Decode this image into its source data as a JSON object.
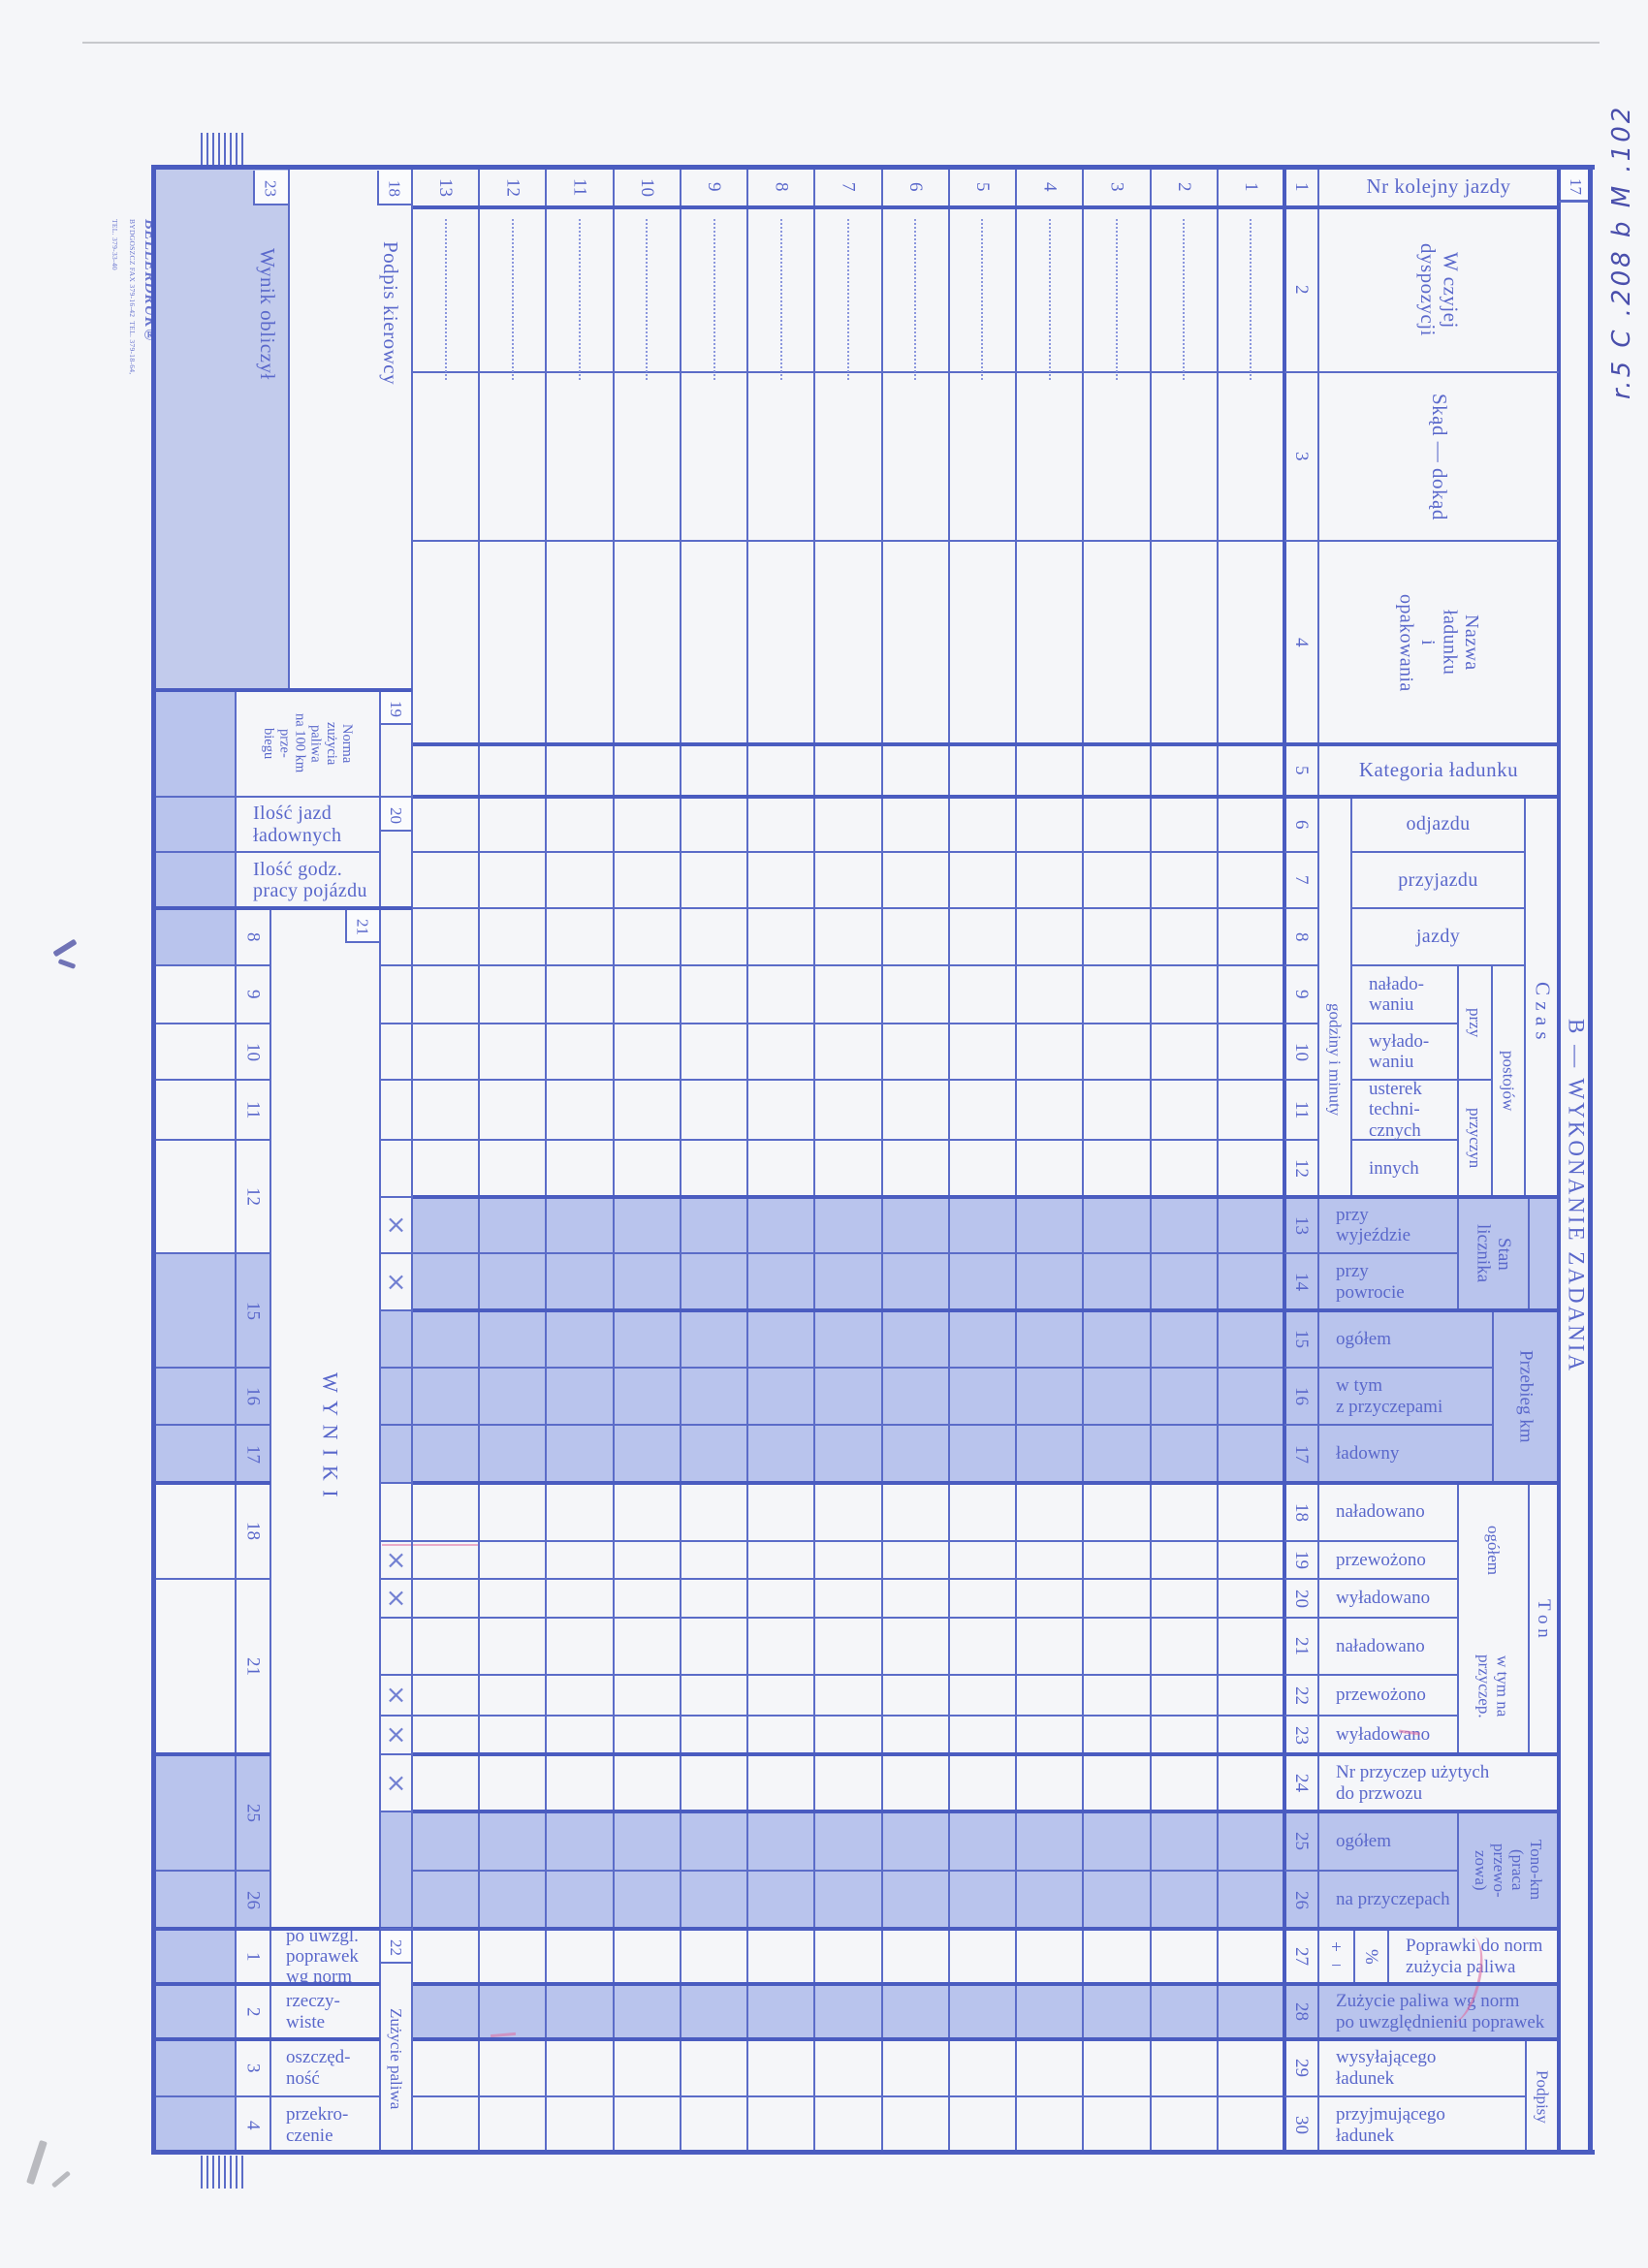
{
  "form": {
    "section_title": "B — WYKONANIE ZADANIA",
    "corner_number": "17",
    "trip_row_numbers": [
      "13",
      "12",
      "11",
      "10",
      "9",
      "8",
      "7",
      "6",
      "5",
      "4",
      "3",
      "2",
      "1"
    ],
    "columns": [
      {
        "num": "1",
        "label": "Nr kolejny jazdy"
      },
      {
        "num": "2",
        "label": "W czyjej\ndyspozycji"
      },
      {
        "num": "3",
        "label": "Skąd — dokąd"
      },
      {
        "num": "4",
        "label": "Nazwa\nładunku\ni\nopakowania"
      },
      {
        "num": "5",
        "label": "Kategoria ładunku"
      },
      {
        "num": "6",
        "label": "odjazdu"
      },
      {
        "num": "7",
        "label": "przyjazdu"
      },
      {
        "num": "8",
        "label": "jazdy"
      },
      {
        "num": "9",
        "label": "nałado-\nwaniu"
      },
      {
        "num": "10",
        "label": "wyłado-\nwaniu"
      },
      {
        "num": "11",
        "label": "usterek\ntechni-\ncznych"
      },
      {
        "num": "12",
        "label": "innych"
      },
      {
        "num": "13",
        "label": "przy\nwyjeździe"
      },
      {
        "num": "14",
        "label": "przy\npowrocie"
      },
      {
        "num": "15",
        "label": "ogółem"
      },
      {
        "num": "16",
        "label": "w tym\nz przyczepami"
      },
      {
        "num": "17",
        "label": "ładowny"
      },
      {
        "num": "18",
        "label": "naładowano"
      },
      {
        "num": "19",
        "label": "przewożono"
      },
      {
        "num": "20",
        "label": "wyładowano"
      },
      {
        "num": "21",
        "label": "naładowano"
      },
      {
        "num": "22",
        "label": "przewożono"
      },
      {
        "num": "23",
        "label": "wyładowano"
      },
      {
        "num": "24",
        "label": "Nr przyczep użytych\ndo przwozu"
      },
      {
        "num": "25",
        "label": "ogółem"
      },
      {
        "num": "26",
        "label": "na przyczepach"
      },
      {
        "num": "27",
        "label": "Poprawki do norm\nzużycia paliwa",
        "signs": "+\n−",
        "percent": "%"
      },
      {
        "num": "28",
        "label": "Zużycie paliwa wg norm\npo uwzględnieniu poprawek"
      },
      {
        "num": "29",
        "label": "wysyłającego\nładunek"
      },
      {
        "num": "30",
        "label": "przyjmującego\nładunek"
      }
    ],
    "groups": {
      "czas": "C z a s",
      "godziny": "godziny i minuty",
      "przy": "przy",
      "postojow": "postojów",
      "przyczyn": "przyczyn",
      "stan_licznika": "Stan\nlicznika",
      "przebieg": "Przebieg km",
      "ogolem": "ogółem",
      "w_tym_na_przyczep": "w tym na\nprzyczep.",
      "ton": "T o n",
      "tono_km": "Tono-km\n(praca\nprzewo-\nzowa)",
      "podpisy": "Podpisy"
    },
    "summary": {
      "wynik_obliczyl": {
        "num": "23",
        "label": "Wynik obliczył"
      },
      "podpis_kierowcy": {
        "num": "18",
        "label": "Podpis kierowcy"
      },
      "norma": {
        "num": "19",
        "label": "Norma\nzużycia\npaliwa\nna 100 km\nprze-\nbiegu"
      },
      "ilosc_jazd": {
        "num": "20",
        "label": "Ilość jazd\nładownych"
      },
      "ilosc_godz": {
        "label": "Ilość godz.\npracy pojázdu"
      },
      "wyniki_box_num": "21",
      "wyniki_title": "W Y N I K I",
      "wyniki_row_numbers": [
        "8",
        "9",
        "10",
        "11",
        "12",
        "15",
        "16",
        "17",
        "18",
        "21",
        "25",
        "26"
      ],
      "zuzycie": {
        "num": "22",
        "label": "Zużycie paliwa",
        "rows": [
          {
            "num": "1",
            "label": "po uwzgl.\npoprawek\nwg norm"
          },
          {
            "num": "2",
            "label": "rzeczy-\nwiste"
          },
          {
            "num": "3",
            "label": "oszczęd-\nność"
          },
          {
            "num": "4",
            "label": "przekro-\nczenie"
          }
        ]
      },
      "cross_mark": "×"
    }
  },
  "imprint": {
    "brand": "BELLERDRUK®",
    "line1": "BYDGOSZCZ  FAX 379-16-42",
    "line2": "TEL. 379-18-64, TEL. 379-33-40"
  },
  "annotations": {
    "handwritten": "r.5 C .208 b M .102"
  },
  "colors": {
    "ink": "#5a68cb",
    "grid_line": "#5b6cc8",
    "grid_line_heavy": "#4a5cc0",
    "band_shade": "#b9c4ed",
    "paper": "#f5f6f9",
    "pen": "#3c41a6"
  }
}
